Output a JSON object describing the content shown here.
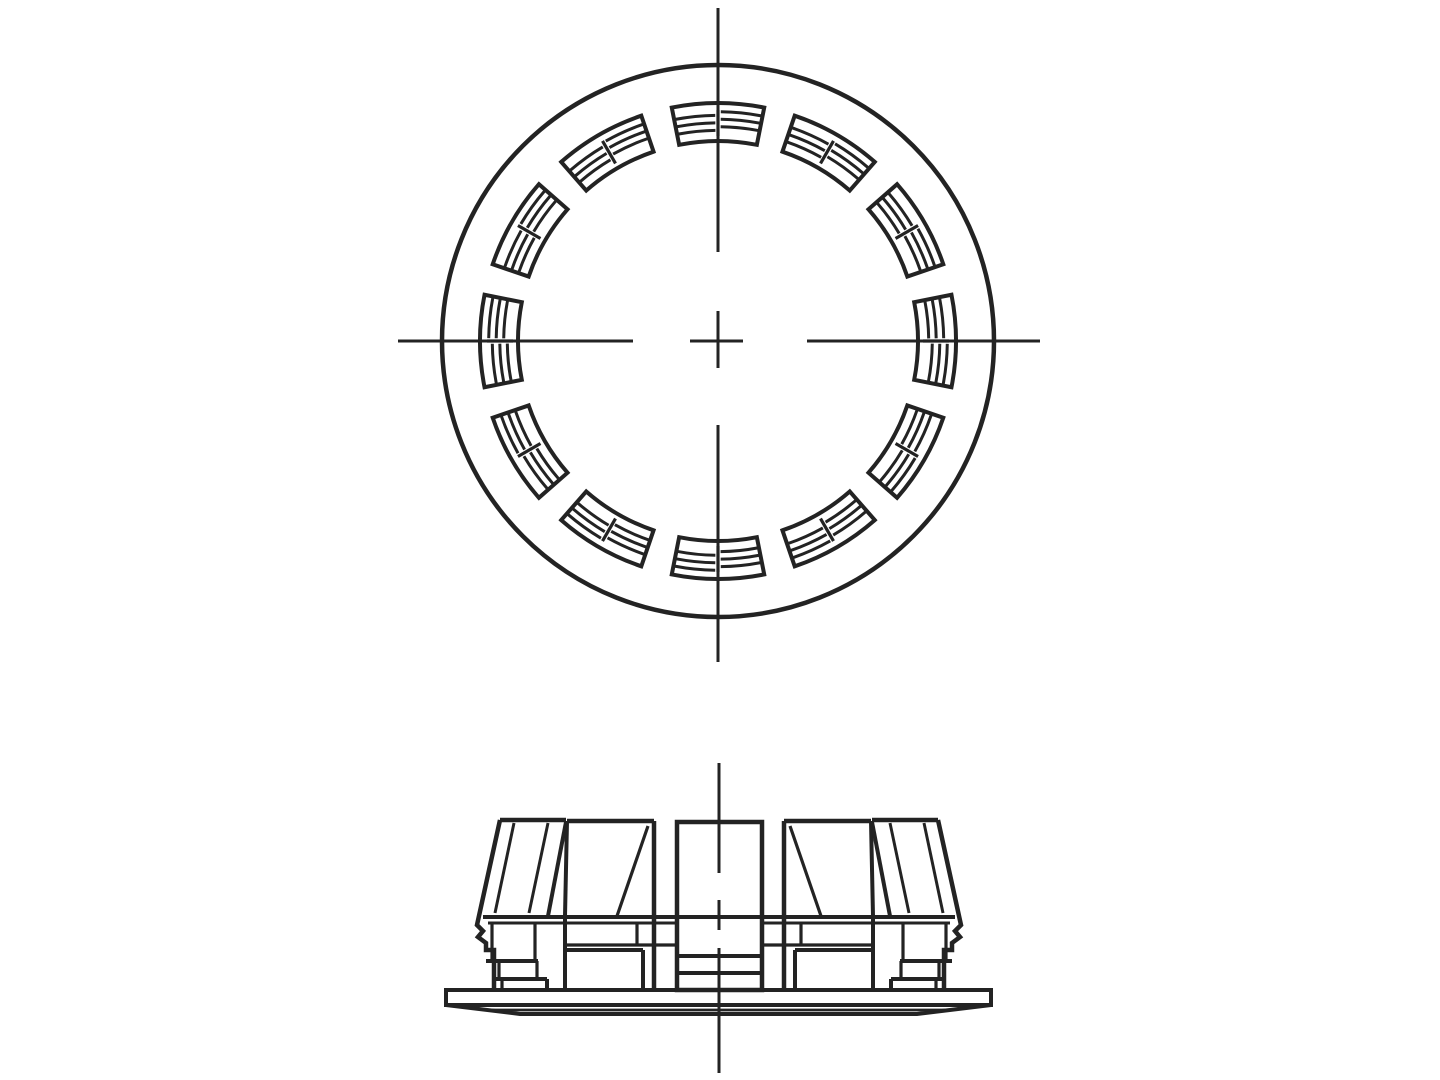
{
  "meta": {
    "description": "Two-view technical line drawing of a snap-in hole plug with serrated retaining fins",
    "background_color": "#ffffff",
    "line_color": "#232323"
  },
  "top_view": {
    "center": {
      "x": 718,
      "y": 341
    },
    "outer_circle": {
      "r": 276,
      "sw": 4.5
    },
    "centerline": {
      "sw": 3,
      "vertical_x": 718,
      "vertical_segments": [
        [
          8,
          252
        ],
        [
          311,
          368
        ],
        [
          425,
          662
        ]
      ],
      "horizontal_y": 341,
      "horizontal_segments": [
        [
          398,
          633
        ],
        [
          690,
          743
        ],
        [
          807,
          1040
        ]
      ]
    },
    "fin_ring": {
      "count": 12,
      "start_angle_deg": 90,
      "step_deg": 30,
      "half_width_deg": 11.2,
      "r_inner": 200,
      "r_outer": 238,
      "rib_radii": [
        212.5,
        220,
        227.5
      ],
      "rib_half_offset": 1.8,
      "rib_inner_gap_deg": 0.7,
      "rib_edge_inset_deg": 0.3,
      "crossbar_r": [
        205,
        231
      ],
      "sw_outline": 4,
      "sw_rib": 3,
      "sw_crossbar": 3.2
    }
  },
  "side_view": {
    "centerline": {
      "x": 719,
      "sw": 3,
      "segments": [
        [
          763,
          873
        ],
        [
          900,
          930
        ],
        [
          948,
          1073
        ]
      ]
    },
    "rects": [
      {
        "name": "flange-plate",
        "x": 446,
        "y": 990,
        "w": 545,
        "h": 15,
        "sw": 4
      },
      {
        "name": "center-prong",
        "x": 677,
        "y": 822,
        "w": 85,
        "h": 168,
        "sw": 4.5
      }
    ],
    "polylines": [
      {
        "name": "flange-bevel",
        "sw": 4,
        "points": [
          [
            446,
            1005
          ],
          [
            520,
            1014
          ],
          [
            917,
            1014
          ],
          [
            991,
            1005
          ]
        ]
      },
      {
        "name": "outer-fin-left-outline",
        "sw": 4.5,
        "points": [
          [
            500,
            820
          ],
          [
            477,
            925
          ],
          [
            483,
            931
          ],
          [
            478,
            937
          ],
          [
            486,
            943
          ],
          [
            486,
            950
          ],
          [
            494,
            950
          ],
          [
            494,
            990
          ]
        ]
      },
      {
        "name": "outer-fin-right-outline",
        "sw": 4.5,
        "points": [
          [
            938,
            820
          ],
          [
            961,
            925
          ],
          [
            955,
            931
          ],
          [
            960,
            937
          ],
          [
            952,
            943
          ],
          [
            952,
            950
          ],
          [
            944,
            950
          ],
          [
            944,
            990
          ]
        ]
      }
    ],
    "lines": [
      {
        "name": "flange-bevel-inner",
        "x1": 490,
        "y1": 1010,
        "x2": 947,
        "y2": 1010,
        "sw": 2.8
      },
      {
        "name": "base-edge",
        "x1": 483,
        "y1": 917,
        "x2": 955,
        "y2": 917,
        "sw": 4
      },
      {
        "name": "base-edge-left",
        "x1": 488,
        "y1": 923,
        "x2": 677,
        "y2": 923,
        "sw": 3
      },
      {
        "name": "base-edge-right",
        "x1": 762,
        "y1": 923,
        "x2": 950,
        "y2": 923,
        "sw": 3
      },
      {
        "name": "prong-step",
        "x1": 677,
        "y1": 956,
        "x2": 762,
        "y2": 956,
        "sw": 4
      },
      {
        "name": "prong-step",
        "x1": 677,
        "y1": 973,
        "x2": 762,
        "y2": 973,
        "sw": 4
      },
      {
        "name": "fin-top",
        "x1": 500,
        "y1": 820,
        "x2": 566,
        "y2": 820,
        "sw": 4.5
      },
      {
        "name": "fin-edge",
        "x1": 566,
        "y1": 822,
        "x2": 548,
        "y2": 916,
        "sw": 4
      },
      {
        "name": "fin-face-line",
        "x1": 514,
        "y1": 823,
        "x2": 495,
        "y2": 913,
        "sw": 3
      },
      {
        "name": "fin-face-line",
        "x1": 548,
        "y1": 823,
        "x2": 529,
        "y2": 913,
        "sw": 3
      },
      {
        "name": "step-v",
        "x1": 492,
        "y1": 923,
        "x2": 492,
        "y2": 961,
        "sw": 3.2
      },
      {
        "name": "step-v",
        "x1": 535,
        "y1": 923,
        "x2": 535,
        "y2": 961,
        "sw": 3.2
      },
      {
        "name": "step-h",
        "x1": 486,
        "y1": 961,
        "x2": 538,
        "y2": 961,
        "sw": 4
      },
      {
        "name": "step-v",
        "x1": 499,
        "y1": 961,
        "x2": 499,
        "y2": 979,
        "sw": 3.2
      },
      {
        "name": "step-v",
        "x1": 537,
        "y1": 961,
        "x2": 537,
        "y2": 979,
        "sw": 3.2
      },
      {
        "name": "step-h",
        "x1": 494,
        "y1": 979,
        "x2": 547,
        "y2": 979,
        "sw": 4
      },
      {
        "name": "step-v",
        "x1": 547,
        "y1": 979,
        "x2": 547,
        "y2": 990,
        "sw": 4
      },
      {
        "name": "step-v",
        "x1": 502,
        "y1": 979,
        "x2": 502,
        "y2": 990,
        "sw": 3.2
      },
      {
        "name": "fin-top",
        "x1": 567,
        "y1": 821,
        "x2": 654,
        "y2": 821,
        "sw": 4.5
      },
      {
        "name": "fin-edge",
        "x1": 567,
        "y1": 821,
        "x2": 565,
        "y2": 916,
        "sw": 4
      },
      {
        "name": "fin-wall",
        "x1": 654,
        "y1": 821,
        "x2": 654,
        "y2": 990,
        "sw": 4.5
      },
      {
        "name": "fin-face-line",
        "x1": 648,
        "y1": 826,
        "x2": 617,
        "y2": 916,
        "sw": 3.2
      },
      {
        "name": "fin-side",
        "x1": 565,
        "y1": 916,
        "x2": 565,
        "y2": 990,
        "sw": 4
      },
      {
        "name": "step-v",
        "x1": 637,
        "y1": 923,
        "x2": 637,
        "y2": 945,
        "sw": 3.2
      },
      {
        "name": "step-h",
        "x1": 566,
        "y1": 945,
        "x2": 677,
        "y2": 945,
        "sw": 3.2
      },
      {
        "name": "step-h",
        "x1": 565,
        "y1": 950,
        "x2": 643,
        "y2": 950,
        "sw": 4
      },
      {
        "name": "step-v",
        "x1": 643,
        "y1": 950,
        "x2": 643,
        "y2": 990,
        "sw": 4
      },
      {
        "name": "fin-top",
        "x1": 784,
        "y1": 821,
        "x2": 871,
        "y2": 821,
        "sw": 4.5
      },
      {
        "name": "fin-edge",
        "x1": 871,
        "y1": 821,
        "x2": 873,
        "y2": 916,
        "sw": 4
      },
      {
        "name": "fin-wall",
        "x1": 784,
        "y1": 821,
        "x2": 784,
        "y2": 990,
        "sw": 4.5
      },
      {
        "name": "fin-face-line",
        "x1": 790,
        "y1": 826,
        "x2": 821,
        "y2": 916,
        "sw": 3.2
      },
      {
        "name": "fin-side",
        "x1": 873,
        "y1": 916,
        "x2": 873,
        "y2": 990,
        "sw": 4
      },
      {
        "name": "step-v",
        "x1": 801,
        "y1": 923,
        "x2": 801,
        "y2": 945,
        "sw": 3.2
      },
      {
        "name": "step-h",
        "x1": 762,
        "y1": 945,
        "x2": 872,
        "y2": 945,
        "sw": 3.2
      },
      {
        "name": "step-h",
        "x1": 795,
        "y1": 950,
        "x2": 873,
        "y2": 950,
        "sw": 4
      },
      {
        "name": "step-v",
        "x1": 795,
        "y1": 950,
        "x2": 795,
        "y2": 990,
        "sw": 4
      },
      {
        "name": "fin-top",
        "x1": 872,
        "y1": 820,
        "x2": 938,
        "y2": 820,
        "sw": 4.5
      },
      {
        "name": "fin-edge",
        "x1": 872,
        "y1": 822,
        "x2": 890,
        "y2": 916,
        "sw": 4
      },
      {
        "name": "fin-face-line",
        "x1": 924,
        "y1": 823,
        "x2": 943,
        "y2": 913,
        "sw": 3
      },
      {
        "name": "fin-face-line",
        "x1": 890,
        "y1": 823,
        "x2": 909,
        "y2": 913,
        "sw": 3
      },
      {
        "name": "step-v",
        "x1": 946,
        "y1": 923,
        "x2": 946,
        "y2": 961,
        "sw": 3.2
      },
      {
        "name": "step-v",
        "x1": 903,
        "y1": 923,
        "x2": 903,
        "y2": 961,
        "sw": 3.2
      },
      {
        "name": "step-h",
        "x1": 900,
        "y1": 961,
        "x2": 952,
        "y2": 961,
        "sw": 4
      },
      {
        "name": "step-v",
        "x1": 939,
        "y1": 961,
        "x2": 939,
        "y2": 979,
        "sw": 3.2
      },
      {
        "name": "step-v",
        "x1": 901,
        "y1": 961,
        "x2": 901,
        "y2": 979,
        "sw": 3.2
      },
      {
        "name": "step-h",
        "x1": 891,
        "y1": 979,
        "x2": 944,
        "y2": 979,
        "sw": 4
      },
      {
        "name": "step-v",
        "x1": 891,
        "y1": 979,
        "x2": 891,
        "y2": 990,
        "sw": 4
      },
      {
        "name": "step-v",
        "x1": 936,
        "y1": 979,
        "x2": 936,
        "y2": 990,
        "sw": 3.2
      }
    ]
  }
}
